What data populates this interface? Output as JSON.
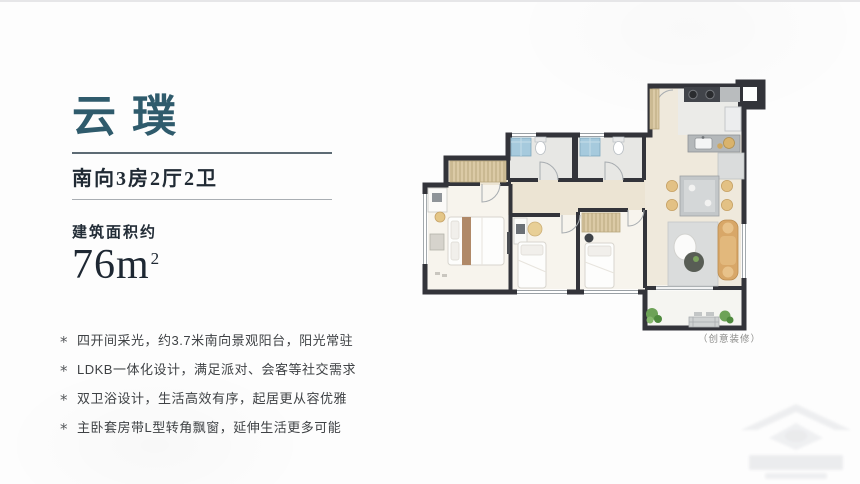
{
  "slide": {
    "title": "云璞",
    "subtitle": "南向3房2厅2卫",
    "area_label": "建筑面积约",
    "area_value": "76m",
    "area_exponent": "2",
    "bullet_glyph": "*",
    "features": [
      "四开间采光，约3.7米南向景观阳台，阳光常驻",
      "LDKB一体化设计，满足派对、会客等社交需求",
      "双卫浴设计，生活高效有序，起居更从容优雅",
      "主卧套房带L型转角飘窗，延伸生活更多可能"
    ],
    "floorplan_caption": "（创意装修）",
    "colors": {
      "title_teal": "#2f5b6c",
      "heading_navy": "#202a34",
      "body_gray": "#3f4245",
      "wall_dark": "#33343a",
      "wardrobe_tan": "#dbcaa6",
      "sofa_tan": "#d8a768",
      "shower_blue": "#a6cadd",
      "plant_green": "#6da257"
    }
  }
}
